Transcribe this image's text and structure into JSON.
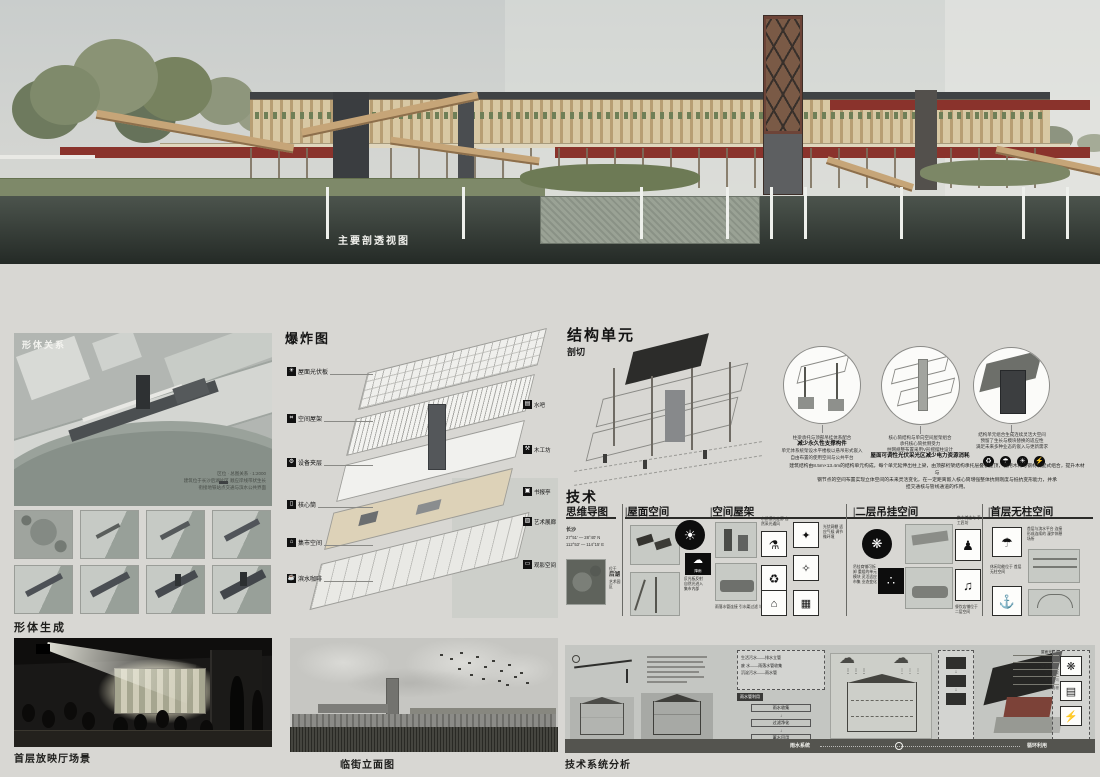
{
  "header": {
    "title": "栖游集市",
    "logo": "CRZY",
    "subtitle1": "基于城市慢行系统的",
    "subtitle2": "地铁口空间更新"
  },
  "hero": {
    "caption": "主要剖透视图"
  },
  "massing": {
    "label": "形体关系",
    "note1": "区位 · 总图关系 · 1:2000",
    "note2": "建筑位于长沙后湖片区 顺应岸线带状生长",
    "note3": "衔接地铁站点交通与滨水公共界面"
  },
  "form_gen": {
    "label": "形体生成"
  },
  "exploded": {
    "label": "爆炸图",
    "left": [
      {
        "icon": "☀",
        "text": "屋面光伏板"
      },
      {
        "icon": "⌗",
        "text": "空间屋架"
      },
      {
        "icon": "⚙",
        "text": "设备夹层"
      },
      {
        "icon": "▯",
        "text": "核心筒"
      },
      {
        "icon": "⌂",
        "text": "集市空间"
      },
      {
        "icon": "☕",
        "text": "滨水咖啡"
      }
    ],
    "right": [
      {
        "icon": "▤",
        "text": "水吧"
      },
      {
        "icon": "⚒",
        "text": "木工坊"
      },
      {
        "icon": "▣",
        "text": "书报亭"
      },
      {
        "icon": "▨",
        "text": "艺术展廊"
      },
      {
        "icon": "▭",
        "text": "观影空间"
      }
    ]
  },
  "structure": {
    "title": "结构单元",
    "subtitle": "剖切",
    "circles": [
      {
        "l1": "柱梁承托与顶部吊挂体系配合",
        "l2": "减少永久性支撑构件",
        "l3": "单元体系统架设水平楼板以悬吊形式嵌入",
        "l4": "自由布置的使用空间与公共平台"
      },
      {
        "l1": "核心筒结构与单向空间屋架组合",
        "l2": "承托核心筒抗侧受力",
        "l3": "柱网规整布置采用V形摇摆柱设计",
        "l4": "屋面可调性光伏采光区减少电力资源消耗"
      },
      {
        "l1": "结构单元组合生成连续灵活大空间",
        "l2": "预留了生长与模块替换的适应性",
        "l3": "满足未来多种业态的嵌入与更新需求"
      }
    ],
    "circle_icons": [
      "♻",
      "☂",
      "☀",
      "⚡"
    ],
    "paragraph1": "建筑结构由8.5m×13.4m的结构单元构成，每个单元延伸出柱上梁，由顶部桁架结构承托层叠板屋顶，使用木材与钢材装配式组合，提升木材与",
    "paragraph2": "钢节点的空间布置实现立体空间的未来灵活变化，在一定距离嵌入核心筒增强整体抗侧刚度与抵抗变形能力，并承",
    "paragraph3": "担交通核与管线通道的作用。"
  },
  "technology": {
    "title": "技术",
    "col1": "思维导图",
    "col2": "|屋面空间",
    "col3": "|空间屋架",
    "col4": "|二层吊挂空间",
    "col5": "|首层无柱空间",
    "mindmap": {
      "city": "长沙",
      "lat": "27°51′ — 28°40′ N",
      "lng": "112°53′ — 114°15′ E",
      "loc1": "位于",
      "loc2": "后湖",
      "loc3": "艺术园区"
    },
    "roof": {
      "sun": "☀",
      "note1": "反光板反射",
      "note2": "自然光进入",
      "note3": "集市内部",
      "cloud": "☁",
      "cloud_label": "降雨"
    },
    "truss": {
      "note_top": "木质模块走廊 自然采光通风",
      "icon1": "⚗",
      "icon2": "♻",
      "note_bottom": "雨落水管连接 引水渠过滤 与蓄水净化",
      "icon3": "✦",
      "icon4": "✧",
      "icon5": "⌂",
      "icon6": "▦",
      "note_right": "光伏网棚 适应气候 调节微环境"
    },
    "hang": {
      "icon_corn": "❋",
      "icon_grape": "∴",
      "note_left": "吊挂商铺可拆卸 重组的单元模块 灵活适应市集 业态变化",
      "note_top": "集市摊主与 手工匠坊",
      "icon_vendor": "♟",
      "icon_drum": "♫",
      "note_bottom": "餐饮店铺位于 二层空间"
    },
    "openfloor": {
      "icon_lounge": "☂",
      "note_top": "首层与滨水平台 连接形成连续的 漫步休憩场所",
      "note_mid": "休闲功能位于 首层无柱空间",
      "icon_boat": "⚓",
      "icon_stage": "▭"
    }
  },
  "tech_panel": {
    "labels": [
      "屋面光伏板",
      "防水卷材",
      "保温隔热层",
      "空间桁架",
      "排水天沟",
      "木格栅"
    ],
    "flows": [
      "生活污水——排水立管",
      "废 水——雨落水管收集",
      "沉淀污水——雨水管"
    ],
    "tag": "雨水管利用",
    "chain": [
      "雨水收集",
      "过滤净化",
      "蓄水回用"
    ],
    "band_left": "雨水系统",
    "band_right": "循环利用"
  },
  "bottom": {
    "scene_caption": "首层放映厅场景",
    "elevation_caption": "临街立面图",
    "tech_caption": "技术系统分析"
  }
}
